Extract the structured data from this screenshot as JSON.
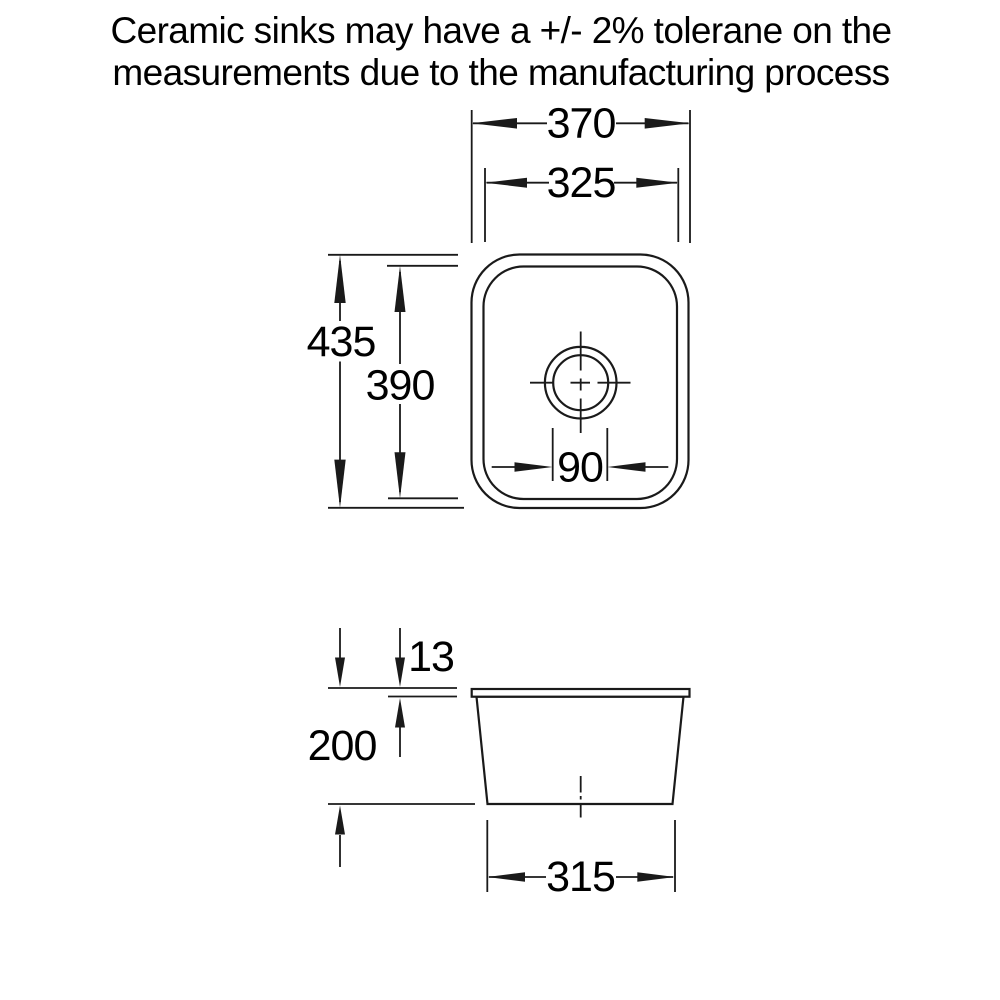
{
  "title": {
    "line1": "Ceramic sinks may have a +/- 2% tolerane on the",
    "line2": "measurements due to the manufacturing process"
  },
  "colors": {
    "background": "#ffffff",
    "line": "#1a1a1a",
    "text": "#000000"
  },
  "top_view": {
    "dims": {
      "outer_width": "370",
      "inner_width": "325",
      "outer_depth": "435",
      "inner_depth": "390",
      "drain_width": "90"
    }
  },
  "side_view": {
    "dims": {
      "rim_height": "13",
      "bowl_depth": "200",
      "base_width": "315"
    }
  }
}
